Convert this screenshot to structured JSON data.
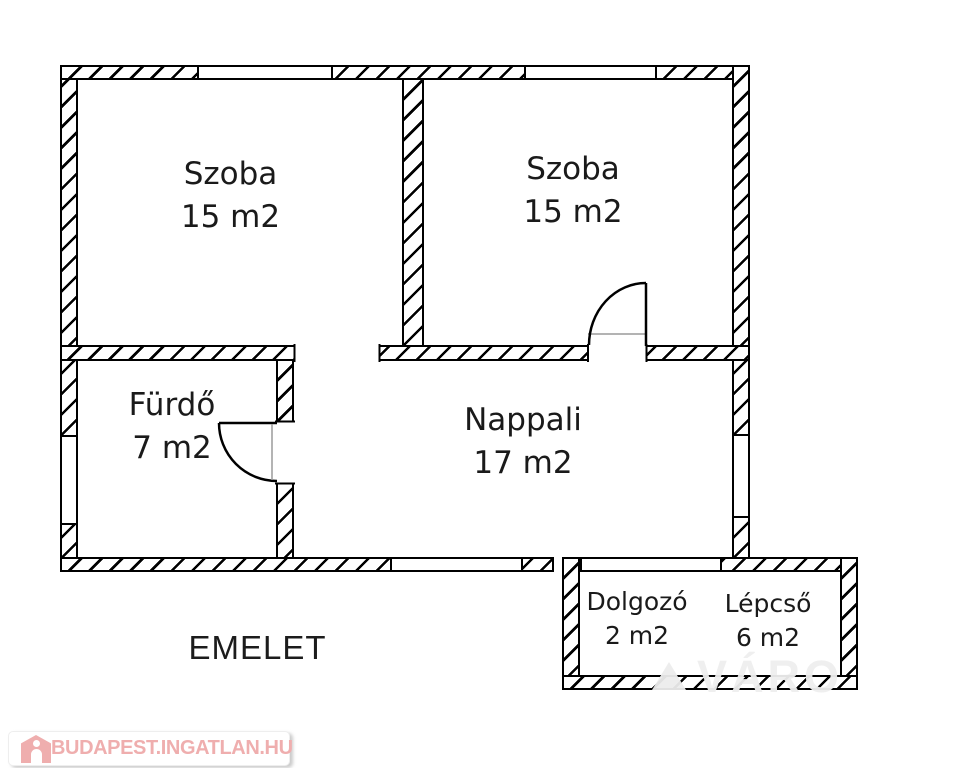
{
  "floor_label": "EMELET",
  "rooms": [
    {
      "id": "szoba-top-left",
      "name": "Szoba",
      "area": "15 m2"
    },
    {
      "id": "szoba-top-right",
      "name": "Szoba",
      "area": "15 m2"
    },
    {
      "id": "furdo",
      "name": "Fürdő",
      "area": "7 m2"
    },
    {
      "id": "nappali",
      "name": "Nappali",
      "area": "17 m2"
    },
    {
      "id": "dolgozo",
      "name": "Dolgozó",
      "area": "2 m2"
    },
    {
      "id": "lepcso",
      "name": "Lépcső",
      "area": "6 m2"
    }
  ],
  "branding": {
    "site_text": "BUDAPEST.INGATLAN.HU",
    "icon": "house-icon"
  },
  "watermark_fragment": "VÁRO",
  "colors": {
    "wall_line": "#000000",
    "background": "#ffffff",
    "brand_pink": "#efaeae",
    "watermark_gray": "#ededed"
  }
}
